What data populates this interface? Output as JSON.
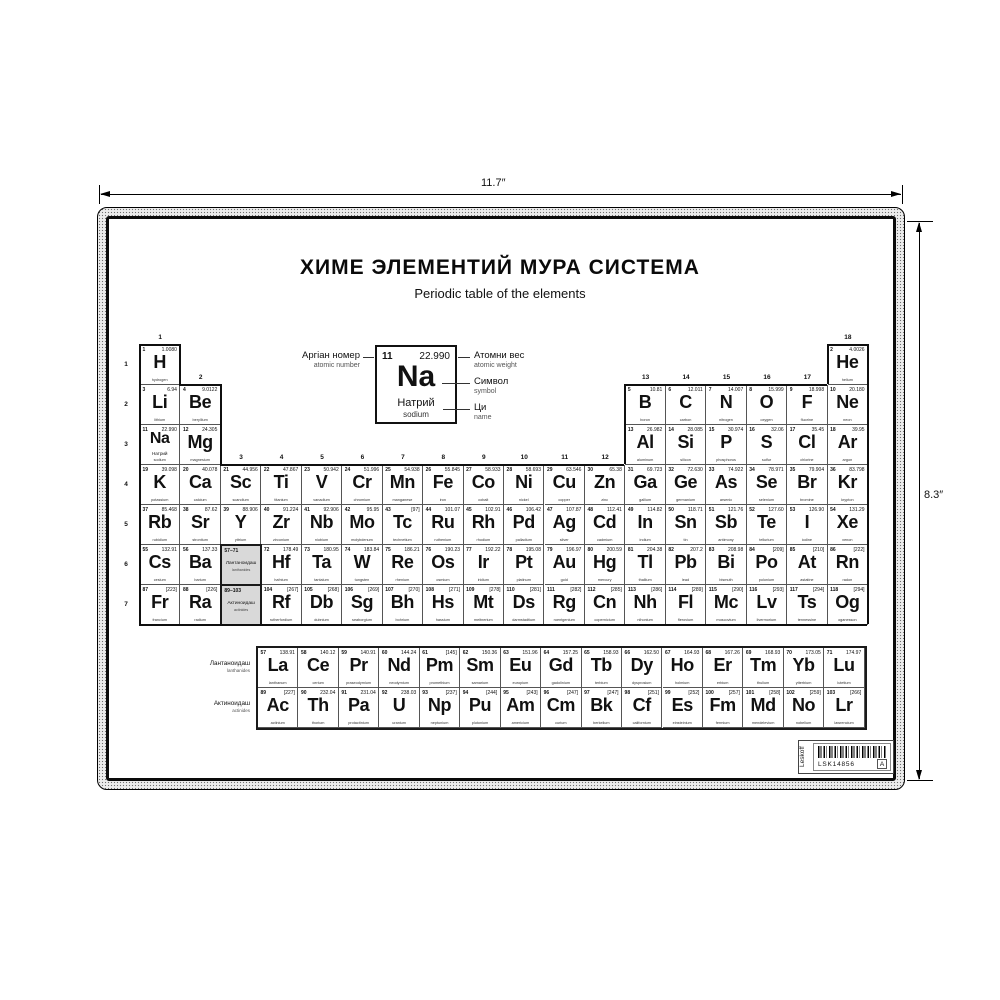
{
  "dimensions": {
    "width_label": "11.7″",
    "height_label": "8.3″"
  },
  "poster": {
    "title": "ХИМЕ ЭЛЕМЕНТИЙ МУРА СИСТЕМА",
    "subtitle": "Periodic table of the elements"
  },
  "legend": {
    "example": {
      "atomic_number": "11",
      "atomic_weight": "22.990",
      "symbol": "Na",
      "name_local": "Натрий",
      "name_en": "sodium"
    },
    "labels": {
      "atomic_number": {
        "local": "Аргіан номер",
        "en": "atomic number"
      },
      "atomic_weight": {
        "local": "Атомни вес",
        "en": "atomic weight"
      },
      "symbol": {
        "local": "Символ",
        "en": "symbol"
      },
      "name": {
        "local": "Ци",
        "en": "name"
      }
    }
  },
  "table": {
    "group_labels": [
      "1",
      "2",
      "3",
      "4",
      "5",
      "6",
      "7",
      "8",
      "9",
      "10",
      "11",
      "12",
      "13",
      "14",
      "15",
      "16",
      "17",
      "18"
    ],
    "period_labels": [
      "1",
      "2",
      "3",
      "4",
      "5",
      "6",
      "7"
    ],
    "element_columns": [
      "atomic_number",
      "symbol",
      "atomic_weight",
      "name_en",
      "period",
      "group",
      "name_local"
    ],
    "elements": [
      [
        1,
        "H",
        "1.0080",
        "hydrogen",
        1,
        1
      ],
      [
        2,
        "He",
        "4.0026",
        "helium",
        1,
        18
      ],
      [
        3,
        "Li",
        "6.94",
        "lithium",
        2,
        1
      ],
      [
        4,
        "Be",
        "9.0122",
        "beryllium",
        2,
        2
      ],
      [
        5,
        "B",
        "10.81",
        "boron",
        2,
        13
      ],
      [
        6,
        "C",
        "12.011",
        "carbon",
        2,
        14
      ],
      [
        7,
        "N",
        "14.007",
        "nitrogen",
        2,
        15
      ],
      [
        8,
        "O",
        "15.999",
        "oxygen",
        2,
        16
      ],
      [
        9,
        "F",
        "18.998",
        "fluorine",
        2,
        17
      ],
      [
        10,
        "Ne",
        "20.180",
        "neon",
        2,
        18
      ],
      [
        11,
        "Na",
        "22.990",
        "sodium",
        3,
        1,
        "Натрий"
      ],
      [
        12,
        "Mg",
        "24.305",
        "magnesium",
        3,
        2
      ],
      [
        13,
        "Al",
        "26.982",
        "aluminum",
        3,
        13
      ],
      [
        14,
        "Si",
        "28.085",
        "silicon",
        3,
        14
      ],
      [
        15,
        "P",
        "30.974",
        "phosphorus",
        3,
        15
      ],
      [
        16,
        "S",
        "32.06",
        "sulfur",
        3,
        16
      ],
      [
        17,
        "Cl",
        "35.45",
        "chlorine",
        3,
        17
      ],
      [
        18,
        "Ar",
        "39.95",
        "argon",
        3,
        18
      ],
      [
        19,
        "K",
        "39.098",
        "potassium",
        4,
        1
      ],
      [
        20,
        "Ca",
        "40.078",
        "calcium",
        4,
        2
      ],
      [
        21,
        "Sc",
        "44.956",
        "scandium",
        4,
        3
      ],
      [
        22,
        "Ti",
        "47.867",
        "titanium",
        4,
        4
      ],
      [
        23,
        "V",
        "50.942",
        "vanadium",
        4,
        5
      ],
      [
        24,
        "Cr",
        "51.996",
        "chromium",
        4,
        6
      ],
      [
        25,
        "Mn",
        "54.938",
        "manganese",
        4,
        7
      ],
      [
        26,
        "Fe",
        "55.845",
        "iron",
        4,
        8
      ],
      [
        27,
        "Co",
        "58.933",
        "cobalt",
        4,
        9
      ],
      [
        28,
        "Ni",
        "58.693",
        "nickel",
        4,
        10
      ],
      [
        29,
        "Cu",
        "63.546",
        "copper",
        4,
        11
      ],
      [
        30,
        "Zn",
        "65.38",
        "zinc",
        4,
        12
      ],
      [
        31,
        "Ga",
        "69.723",
        "gallium",
        4,
        13
      ],
      [
        32,
        "Ge",
        "72.630",
        "germanium",
        4,
        14
      ],
      [
        33,
        "As",
        "74.922",
        "arsenic",
        4,
        15
      ],
      [
        34,
        "Se",
        "78.971",
        "selenium",
        4,
        16
      ],
      [
        35,
        "Br",
        "79.904",
        "bromine",
        4,
        17
      ],
      [
        36,
        "Kr",
        "83.798",
        "krypton",
        4,
        18
      ],
      [
        37,
        "Rb",
        "85.468",
        "rubidium",
        5,
        1
      ],
      [
        38,
        "Sr",
        "87.62",
        "strontium",
        5,
        2
      ],
      [
        39,
        "Y",
        "88.906",
        "yttrium",
        5,
        3
      ],
      [
        40,
        "Zr",
        "91.224",
        "zirconium",
        5,
        4
      ],
      [
        41,
        "Nb",
        "92.906",
        "niobium",
        5,
        5
      ],
      [
        42,
        "Mo",
        "95.95",
        "molybdenum",
        5,
        6
      ],
      [
        43,
        "Tc",
        "[97]",
        "technetium",
        5,
        7
      ],
      [
        44,
        "Ru",
        "101.07",
        "ruthenium",
        5,
        8
      ],
      [
        45,
        "Rh",
        "102.91",
        "rhodium",
        5,
        9
      ],
      [
        46,
        "Pd",
        "106.42",
        "palladium",
        5,
        10
      ],
      [
        47,
        "Ag",
        "107.87",
        "silver",
        5,
        11
      ],
      [
        48,
        "Cd",
        "112.41",
        "cadmium",
        5,
        12
      ],
      [
        49,
        "In",
        "114.82",
        "indium",
        5,
        13
      ],
      [
        50,
        "Sn",
        "118.71",
        "tin",
        5,
        14
      ],
      [
        51,
        "Sb",
        "121.76",
        "antimony",
        5,
        15
      ],
      [
        52,
        "Te",
        "127.60",
        "tellurium",
        5,
        16
      ],
      [
        53,
        "I",
        "126.90",
        "iodine",
        5,
        17
      ],
      [
        54,
        "Xe",
        "131.29",
        "xenon",
        5,
        18
      ],
      [
        55,
        "Cs",
        "132.91",
        "cesium",
        6,
        1
      ],
      [
        56,
        "Ba",
        "137.33",
        "barium",
        6,
        2
      ],
      [
        72,
        "Hf",
        "178.49",
        "hafnium",
        6,
        4
      ],
      [
        73,
        "Ta",
        "180.95",
        "tantalum",
        6,
        5
      ],
      [
        74,
        "W",
        "183.84",
        "tungsten",
        6,
        6
      ],
      [
        75,
        "Re",
        "186.21",
        "rhenium",
        6,
        7
      ],
      [
        76,
        "Os",
        "190.23",
        "osmium",
        6,
        8
      ],
      [
        77,
        "Ir",
        "192.22",
        "iridium",
        6,
        9
      ],
      [
        78,
        "Pt",
        "195.08",
        "platinum",
        6,
        10
      ],
      [
        79,
        "Au",
        "196.97",
        "gold",
        6,
        11
      ],
      [
        80,
        "Hg",
        "200.59",
        "mercury",
        6,
        12
      ],
      [
        81,
        "Tl",
        "204.38",
        "thallium",
        6,
        13
      ],
      [
        82,
        "Pb",
        "207.2",
        "lead",
        6,
        14
      ],
      [
        83,
        "Bi",
        "208.98",
        "bismuth",
        6,
        15
      ],
      [
        84,
        "Po",
        "[209]",
        "polonium",
        6,
        16
      ],
      [
        85,
        "At",
        "[210]",
        "astatine",
        6,
        17
      ],
      [
        86,
        "Rn",
        "[222]",
        "radon",
        6,
        18
      ],
      [
        87,
        "Fr",
        "[223]",
        "francium",
        7,
        1
      ],
      [
        88,
        "Ra",
        "[226]",
        "radium",
        7,
        2
      ],
      [
        104,
        "Rf",
        "[267]",
        "rutherfordium",
        7,
        4
      ],
      [
        105,
        "Db",
        "[268]",
        "dubnium",
        7,
        5
      ],
      [
        106,
        "Sg",
        "[269]",
        "seaborgium",
        7,
        6
      ],
      [
        107,
        "Bh",
        "[270]",
        "bohrium",
        7,
        7
      ],
      [
        108,
        "Hs",
        "[271]",
        "hassium",
        7,
        8
      ],
      [
        109,
        "Mt",
        "[278]",
        "meitnerium",
        7,
        9
      ],
      [
        110,
        "Ds",
        "[281]",
        "darmstadtium",
        7,
        10
      ],
      [
        111,
        "Rg",
        "[282]",
        "roentgenium",
        7,
        11
      ],
      [
        112,
        "Cn",
        "[285]",
        "copernicium",
        7,
        12
      ],
      [
        113,
        "Nh",
        "[286]",
        "nihonium",
        7,
        13
      ],
      [
        114,
        "Fl",
        "[289]",
        "flerovium",
        7,
        14
      ],
      [
        115,
        "Mc",
        "[290]",
        "moscovium",
        7,
        15
      ],
      [
        116,
        "Lv",
        "[293]",
        "livermorium",
        7,
        16
      ],
      [
        117,
        "Ts",
        "[294]",
        "tennessine",
        7,
        17
      ],
      [
        118,
        "Og",
        "[294]",
        "oganesson",
        7,
        18
      ]
    ],
    "placeholders": [
      {
        "range": "57–71",
        "local": "Лантаноидаш",
        "en": "lanthanides",
        "period": 6,
        "group": 3
      },
      {
        "range": "89–103",
        "local": "Актиноидаш",
        "en": "actinides",
        "period": 7,
        "group": 3
      }
    ],
    "fblock": {
      "rows": [
        {
          "label_local": "Лантаноидаш",
          "label_en": "lanthanides",
          "elements": [
            [
              57,
              "La",
              "138.91",
              "lanthanum"
            ],
            [
              58,
              "Ce",
              "140.12",
              "cerium"
            ],
            [
              59,
              "Pr",
              "140.91",
              "praseodymium"
            ],
            [
              60,
              "Nd",
              "144.24",
              "neodymium"
            ],
            [
              61,
              "Pm",
              "[145]",
              "promethium"
            ],
            [
              62,
              "Sm",
              "150.36",
              "samarium"
            ],
            [
              63,
              "Eu",
              "151.96",
              "europium"
            ],
            [
              64,
              "Gd",
              "157.25",
              "gadolinium"
            ],
            [
              65,
              "Tb",
              "158.93",
              "terbium"
            ],
            [
              66,
              "Dy",
              "162.50",
              "dysprosium"
            ],
            [
              67,
              "Ho",
              "164.93",
              "holmium"
            ],
            [
              68,
              "Er",
              "167.26",
              "erbium"
            ],
            [
              69,
              "Tm",
              "168.93",
              "thulium"
            ],
            [
              70,
              "Yb",
              "173.05",
              "ytterbium"
            ],
            [
              71,
              "Lu",
              "174.97",
              "lutetium"
            ]
          ]
        },
        {
          "label_local": "Актиноидаш",
          "label_en": "actinides",
          "elements": [
            [
              89,
              "Ac",
              "[227]",
              "actinium"
            ],
            [
              90,
              "Th",
              "232.04",
              "thorium"
            ],
            [
              91,
              "Pa",
              "231.04",
              "protactinium"
            ],
            [
              92,
              "U",
              "238.03",
              "uranium"
            ],
            [
              93,
              "Np",
              "[237]",
              "neptunium"
            ],
            [
              94,
              "Pu",
              "[244]",
              "plutonium"
            ],
            [
              95,
              "Am",
              "[243]",
              "americium"
            ],
            [
              96,
              "Cm",
              "[247]",
              "curium"
            ],
            [
              97,
              "Bk",
              "[247]",
              "berkelium"
            ],
            [
              98,
              "Cf",
              "[251]",
              "californium"
            ],
            [
              99,
              "Es",
              "[252]",
              "einsteinium"
            ],
            [
              100,
              "Fm",
              "[257]",
              "fermium"
            ],
            [
              101,
              "Md",
              "[258]",
              "mendelevium"
            ],
            [
              102,
              "No",
              "[259]",
              "nobelium"
            ],
            [
              103,
              "Lr",
              "[266]",
              "lawrencium"
            ]
          ]
        }
      ]
    }
  },
  "footer_label": {
    "brand": "Leskoff",
    "code": "LSK14856",
    "corner_mark": "A"
  },
  "colors": {
    "ink": "#111111",
    "placeholder_bg": "#d9d9d9",
    "frame_stipple": "#ececec"
  }
}
